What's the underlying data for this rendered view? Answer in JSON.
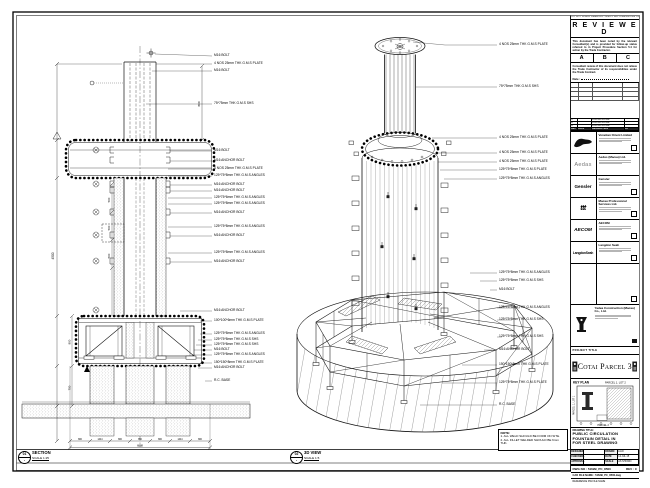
{
  "section_view": {
    "ref": "01",
    "dash": "-",
    "title": "SECTION",
    "scale": "SCALE 1:25",
    "labels": [
      {
        "text": "M16 BOLT"
      },
      {
        "text": "4 NOS 25mm THK G.M.S PLATE"
      },
      {
        "text": "M16 BOLT"
      },
      {
        "text": "75*75mm THK G.M.S SHS"
      },
      {
        "text": "M16 BOLT"
      },
      {
        "text": "M16 ANCHOR BOLT"
      },
      {
        "text": "4 NOS 25mm THK G.M.S PLATE"
      },
      {
        "text": "125*75*8mm THK G.M.S ANGLES"
      },
      {
        "text": "M16 ANCHOR BOLT"
      },
      {
        "text": "M16 ANCHOR BOLT"
      },
      {
        "text": "125*75*6mm THK G.M.S ANGLES"
      },
      {
        "text": "125*75*8mm THK G.M.S ANGLES"
      },
      {
        "text": "M16 ANCHOR BOLT"
      },
      {
        "text": "125*75*8mm THK G.M.S ANGLES"
      },
      {
        "text": "M16 ANCHOR BOLT"
      },
      {
        "text": "125*75*8mm THK G.M.S ANGLES"
      },
      {
        "text": "M16 ANCHOR BOLT"
      },
      {
        "text": "M16 ANCHOR BOLT"
      },
      {
        "text": "100*100*6mm THK G.M.S PLATE"
      },
      {
        "text": "125*75*8mm THK G.M.S ANGLES"
      },
      {
        "text": "125*75*8mm THK G.M.S SHS"
      },
      {
        "text": "125*75*8mm THK G.M.S SHS"
      },
      {
        "text": "M16 BOLT"
      },
      {
        "text": "125*75*8mm THK G.M.S ANGLES"
      },
      {
        "text": "150*150*8mm THK G.M.S PLATE"
      },
      {
        "text": "M16 ANCHOR BOLT"
      },
      {
        "text": "R.C. BASE"
      }
    ],
    "dims": {
      "left_total": "4500",
      "top_right": "800",
      "inner": [
        "500",
        "500",
        "500"
      ],
      "base_heights": [
        "800",
        "750"
      ],
      "bottom": [
        "800",
        "1444",
        "800",
        "850",
        "800",
        "1444",
        "800"
      ],
      "bottom_total": "6888"
    }
  },
  "view3d": {
    "ref": "02",
    "dash": "-",
    "title": "3D VIEW",
    "scale": "SCALE 1:5",
    "labels": [
      {
        "text": "4 NOS 25mm THK G.M.S PLATE"
      },
      {
        "text": "75*75mm THK G.M.S SHS"
      },
      {
        "text": "4 NOS 25mm THK G.M.S PLATE"
      },
      {
        "text": "4 NOS 25mm THK G.M.S PLATE"
      },
      {
        "text": "4 NOS 25mm THK G.M.S PLATE"
      },
      {
        "text": "125*75*8mm THK G.M.S PLATE"
      },
      {
        "text": "125*75*8mm THK G.M.S ANGLES"
      },
      {
        "text": "125*75*8mm THK G.M.S ANGLES"
      },
      {
        "text": "125*75*8mm THK G.M.S SHS"
      },
      {
        "text": "M16 BOLT"
      },
      {
        "text": "125*75*8mm THK G.M.S ANGLES"
      },
      {
        "text": "125*75*8mm THK G.M.S SHS"
      },
      {
        "text": "125*75*8mm THK G.M.S SHS"
      },
      {
        "text": "M16 ANCHOR BOLT"
      },
      {
        "text": "150*150*8mm THK G.M.S PLATE"
      },
      {
        "text": "125*75*8mm THK G.M.S PLATE"
      },
      {
        "text": "R.C. BASE"
      }
    ]
  },
  "notes": {
    "heading": "NOTE:",
    "line1": "1. ALL WELD SHOULD BE FORM ON SITE.",
    "line2": "2. ALL FILLET WELDED SHOULD BE 6mm THK."
  },
  "stamp": {
    "header": "DO NOT SCALE DRAWING. VERIFY ALL DIMENSIONS ON SITE.",
    "title": "R E V I E W E D",
    "para1": "This document has been noted by the relevant Consultant(s) and is provided for follow-up status referred to in Project Procedure Section 5.4 for action by the Trade Contractor.",
    "options": [
      "A",
      "B",
      "C"
    ],
    "para2": "Consultant review of this document does not relieve the Trade Contractor of its responsibilities under the Trade Contract.",
    "date_label": "Date :"
  },
  "revisions": {
    "headers": [
      "REV",
      "DATE",
      "DESCRIPTION",
      "BY"
    ],
    "rows": [
      {
        "rev": "C",
        "date": "",
        "desc": "FOR APPROVAL",
        "by": ""
      },
      {
        "rev": "B",
        "date": "",
        "desc": "FOR APPROVAL",
        "by": ""
      },
      {
        "rev": "A",
        "date": "",
        "desc": "FOR APPROVAL",
        "by": ""
      }
    ]
  },
  "consultants": [
    {
      "logo": "",
      "name": "Venetian Orient Limited",
      "logo_icon": "venetian-mark"
    },
    {
      "logo": "Aedas",
      "name": "Aedas (Macau) Ltd.",
      "logo_icon": "aedas-wordmark"
    },
    {
      "logo": "Gensler",
      "name": "Gensler",
      "logo_icon": "gensler-wordmark"
    },
    {
      "logo": "ttt",
      "name": "Macau Professional Services Ltd.",
      "logo_icon": "ttt-wordmark"
    },
    {
      "logo": "AECOM",
      "name": "AECOM",
      "logo_icon": "aecom-wordmark"
    },
    {
      "logo": "LangdonSeah",
      "name": "Langdon Seah",
      "logo_icon": "langdon-seah-wordmark"
    },
    {
      "logo": "",
      "name": "",
      "logo_icon": "empty"
    }
  ],
  "contractor": {
    "name": "Yadea Construction (Macau) Co., Ltd."
  },
  "project": {
    "label": "PROJECT TITLE",
    "name": "Cotai Parcel 3"
  },
  "key_plan": {
    "label": "KEY PLAN",
    "parcel_top": "PARCEL 1, LOT 2",
    "parcel_left": "PARCEL 1, LOT 1",
    "parcel_bottom": "PARCEL 2"
  },
  "title_block": {
    "drawing_title_label": "DRAWING TITLE:",
    "line1": "PUBLIC CIRCULATION",
    "line2": "FOUNTAIN DETAIL IN",
    "line3": "FOR STEEL DRAWING",
    "f1l": "DESIGNED",
    "f1v": "",
    "f2l": "DRAWN",
    "f2v": "LIAO",
    "f3l": "CHECKED",
    "f3v": "-",
    "f4l": "DATE",
    "f4v": "14.JUL.15",
    "f5l": "APPROVED",
    "f5v": "-",
    "f6l": "SCALE",
    "f6v": "AS SHOWN",
    "dwg_label": "DWG NO : 5162B_PC_8500",
    "rev_label": "REV : C",
    "file_label": "CAD FILE NAME : 5162B_PC_8500.dwg",
    "reference_label": "REFERENCE DW FILE NAME"
  }
}
